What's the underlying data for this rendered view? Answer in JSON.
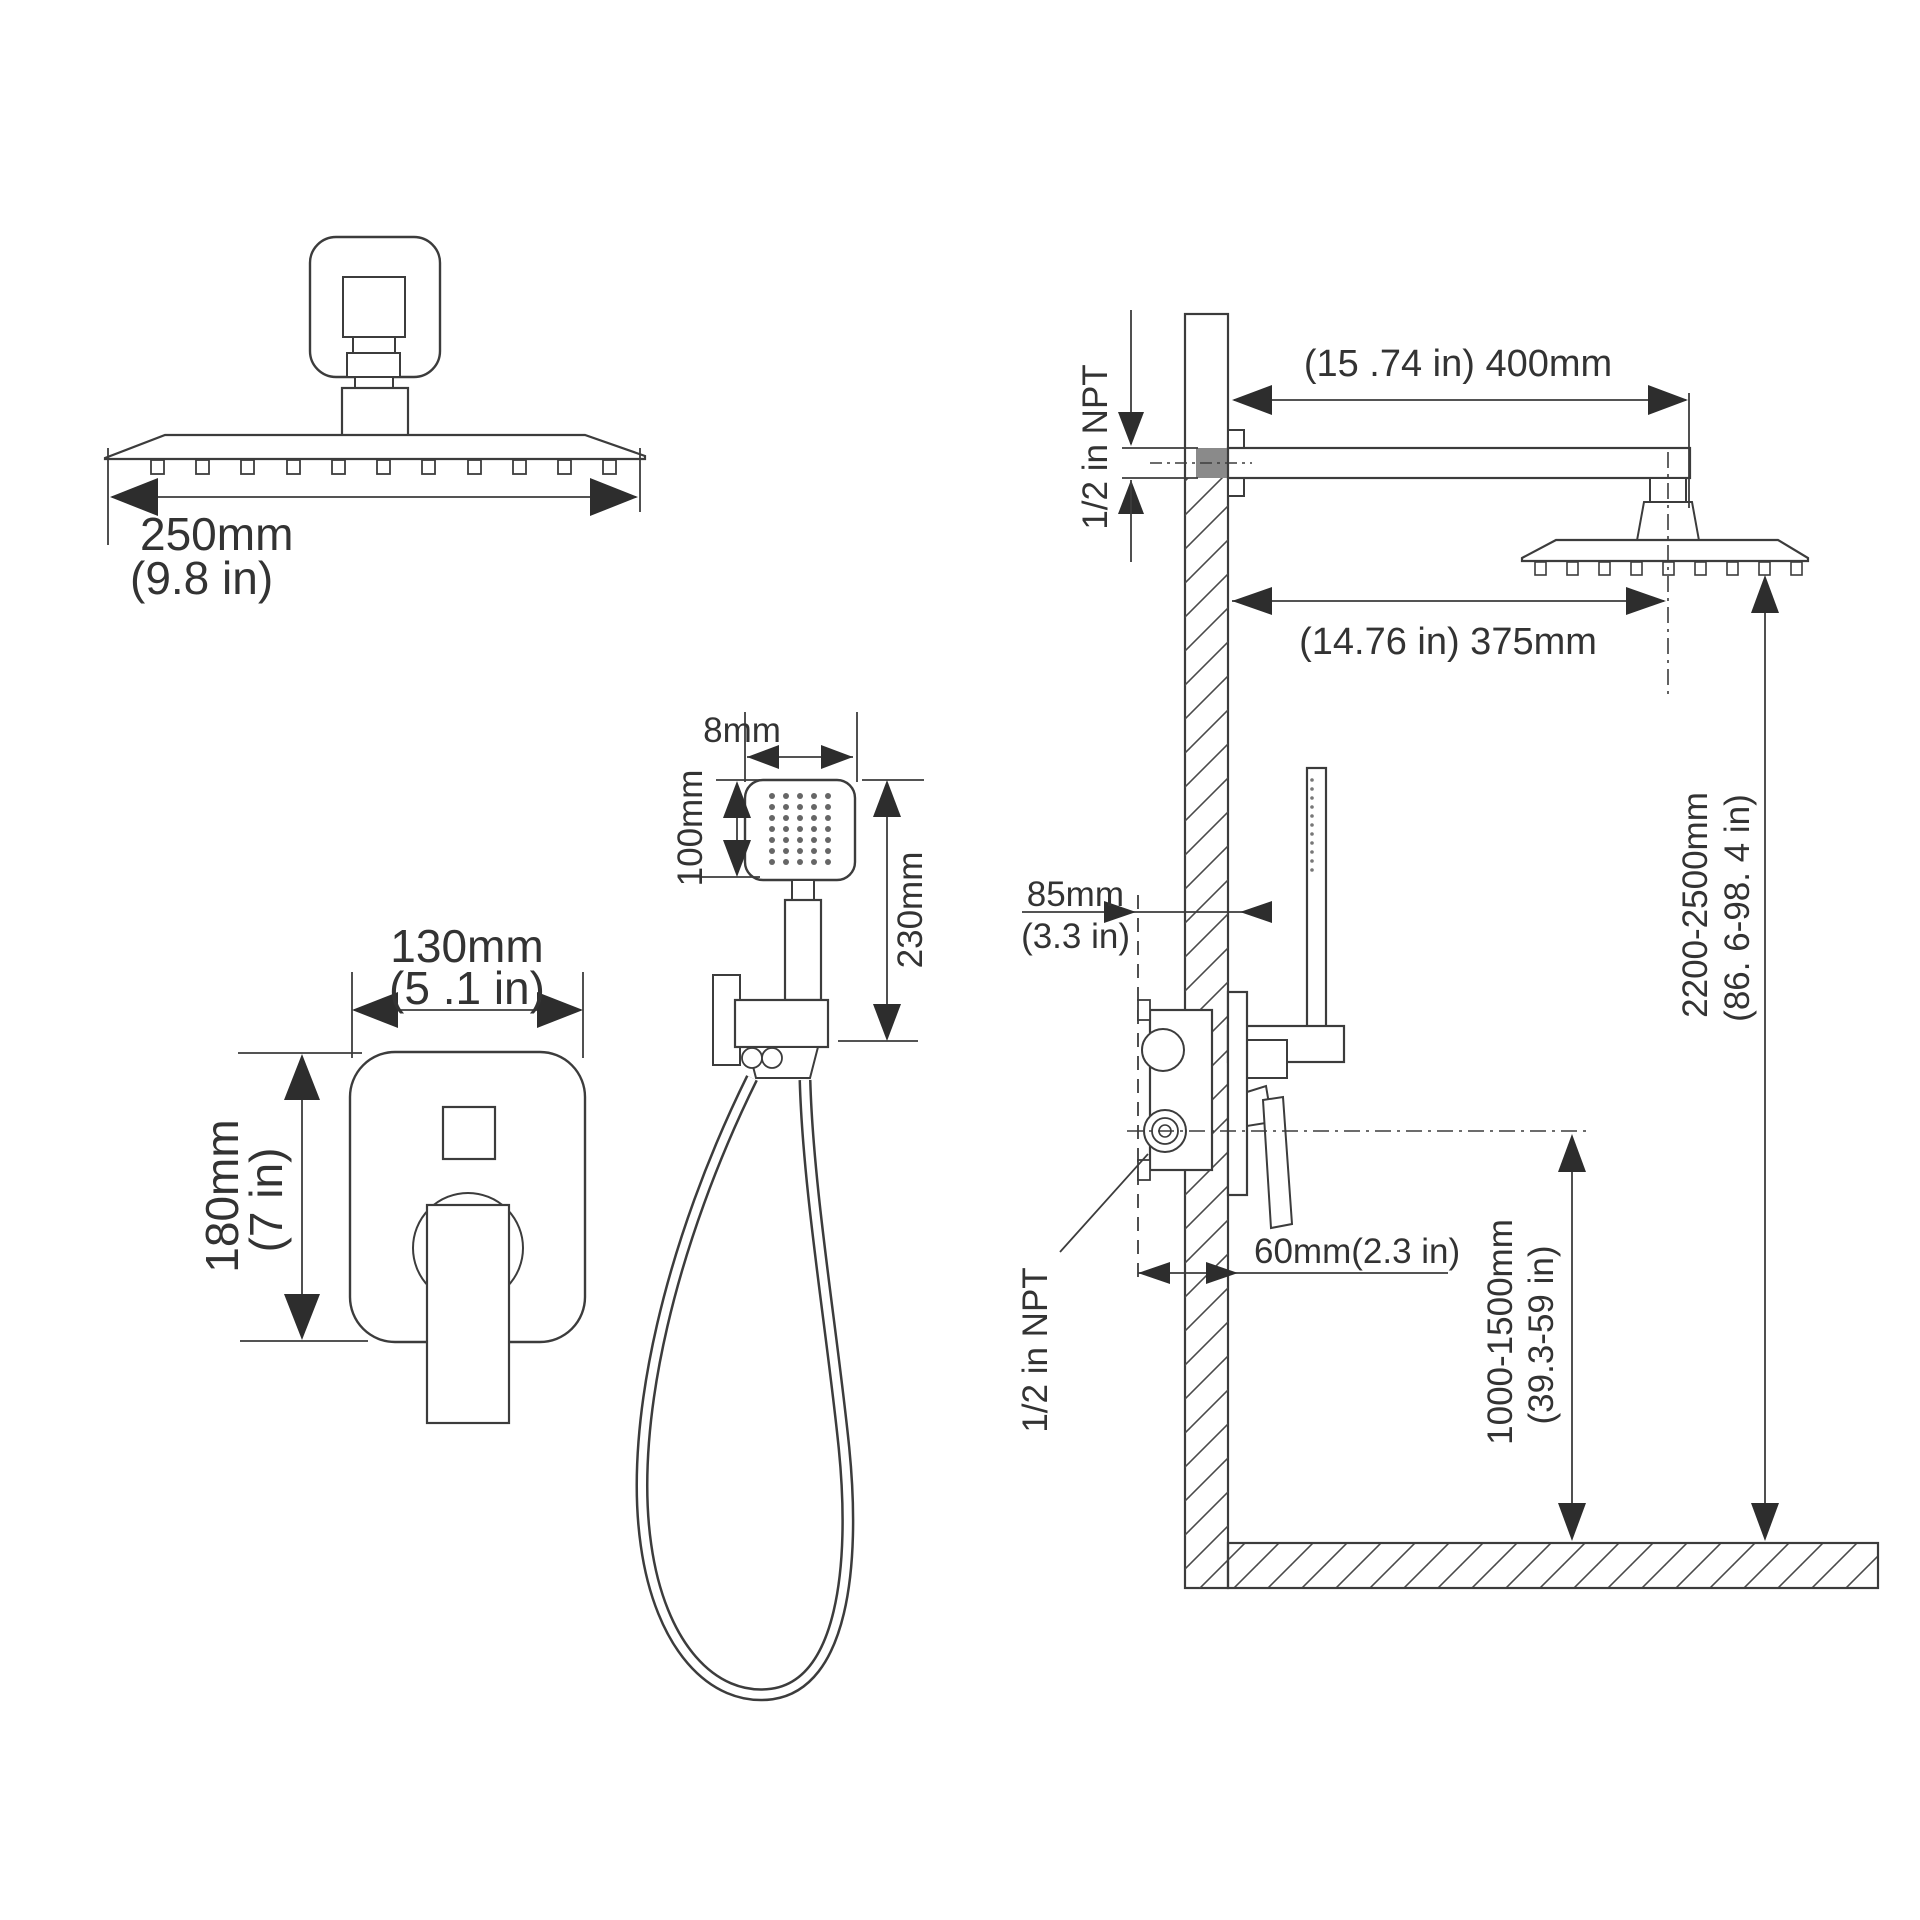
{
  "drawing": {
    "type": "shower-system-installation-dimension-diagram",
    "background": "#ffffff",
    "line_color": "#3c3c3c",
    "pipe_fill_color": "#8a8a8a",
    "labels": {
      "rain_head_width_mm": "250mm",
      "rain_head_width_in": "(9.8 in)",
      "valve_width_mm": "130mm",
      "valve_width_in": "(5 .1 in)",
      "valve_height_mm": "180mm",
      "valve_height_in": "(7 in)",
      "hand_head_width": "8mm",
      "hand_head_height": "100mm",
      "hand_total_height": "230mm",
      "arm_length": "(15 .74 in) 400mm",
      "arm_thread": "1/2 in NPT",
      "head_wall_distance": "(14.76 in) 375mm",
      "rough_in_mm": "85mm",
      "rough_in_in": "(3.3 in)",
      "valve_depth": "60mm(2.3 in)",
      "valve_thread": "1/2 in NPT",
      "valve_height_range_mm": "1000-1500mm",
      "valve_height_range_in": "(39.3-59 in)",
      "head_height_range_mm": "2200-2500mm",
      "head_height_range_in": "(86. 6-98. 4 in)"
    }
  }
}
